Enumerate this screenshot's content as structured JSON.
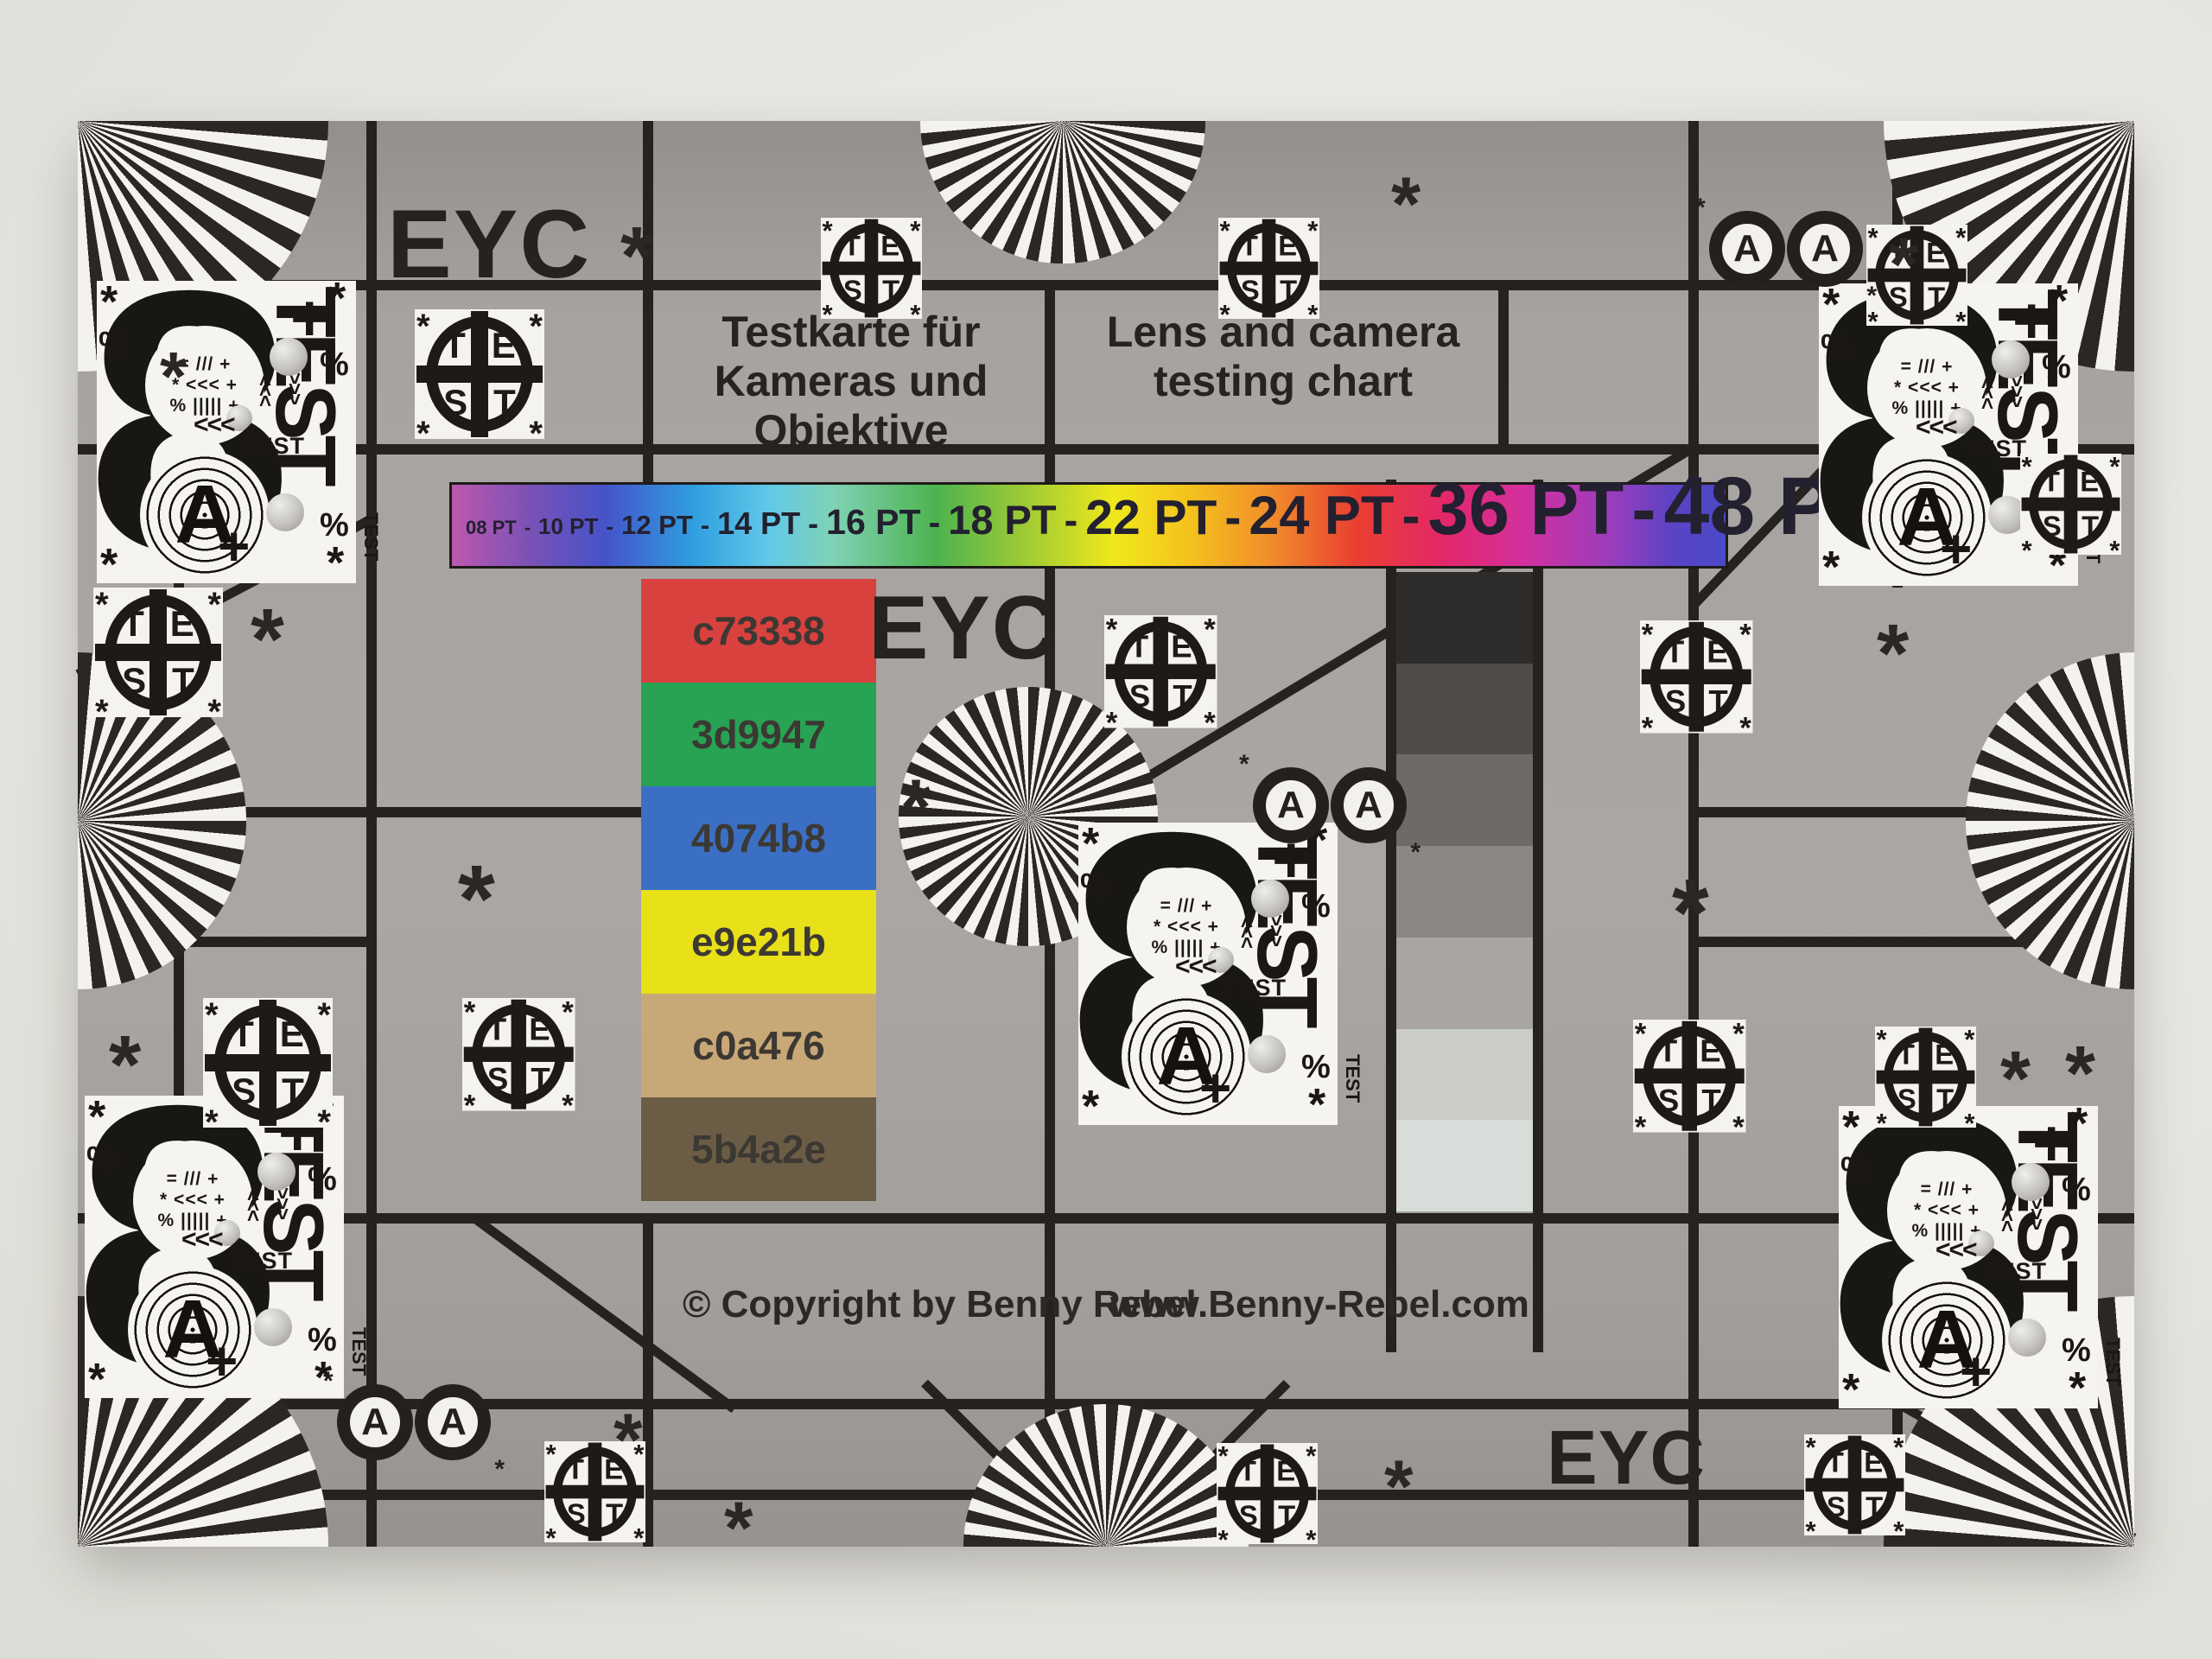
{
  "chart": {
    "name": "lens-test-chart",
    "eyc": "EYC",
    "title_de_line1": "Testkarte für",
    "title_de_line2": "Kameras und Objektive",
    "title_en_line1": "Lens and camera",
    "title_en_line2": "testing chart",
    "copyright": "© Copyright by Benny Rebel",
    "website": "www.Benny-Rebel.com"
  },
  "pt_scale": {
    "labels": [
      "08 PT",
      "10 PT",
      "12 PT",
      "14 PT",
      "16 PT",
      "18 PT",
      "22 PT",
      "24 PT",
      "36 PT",
      "48 PT"
    ],
    "separator": "-"
  },
  "swatches": [
    {
      "label": "c73338",
      "color": "#d8413e"
    },
    {
      "label": "3d9947",
      "color": "#27a353"
    },
    {
      "label": "4074b8",
      "color": "#3b6fc4"
    },
    {
      "label": "e9e21b",
      "color": "#e8e019"
    },
    {
      "label": "c0a476",
      "color": "#c9a878"
    },
    {
      "label": "5b4a2e",
      "color": "#6b5d45"
    }
  ],
  "grayscale_steps": [
    {
      "color": "#2e2c2a"
    },
    {
      "color": "#4e4b49"
    },
    {
      "color": "#6e6a67"
    },
    {
      "color": "#8b8784"
    },
    {
      "color": "#a8a5a2"
    },
    {
      "color": "#cbcdc9"
    },
    {
      "color": "#d9ddd9"
    }
  ],
  "test_marker": {
    "top": "TE",
    "bottom": "ST"
  },
  "block8": {
    "digit": "8",
    "letter": "A",
    "test_large": "TEST",
    "test_small": "TEST",
    "test_side": "TEST"
  },
  "glyphs": {
    "asterisk": "*",
    "percent": "%",
    "plus": "+",
    "chevrons": "<<<",
    "mini1": "= /// +",
    "mini2": "* <<< +",
    "mini3": "% ||||| +"
  },
  "colors": {
    "chart_gray": "#a7a3a0",
    "line_black": "#26221f",
    "paper_white": "#f4f3ef",
    "background": "#e6e5e0"
  }
}
